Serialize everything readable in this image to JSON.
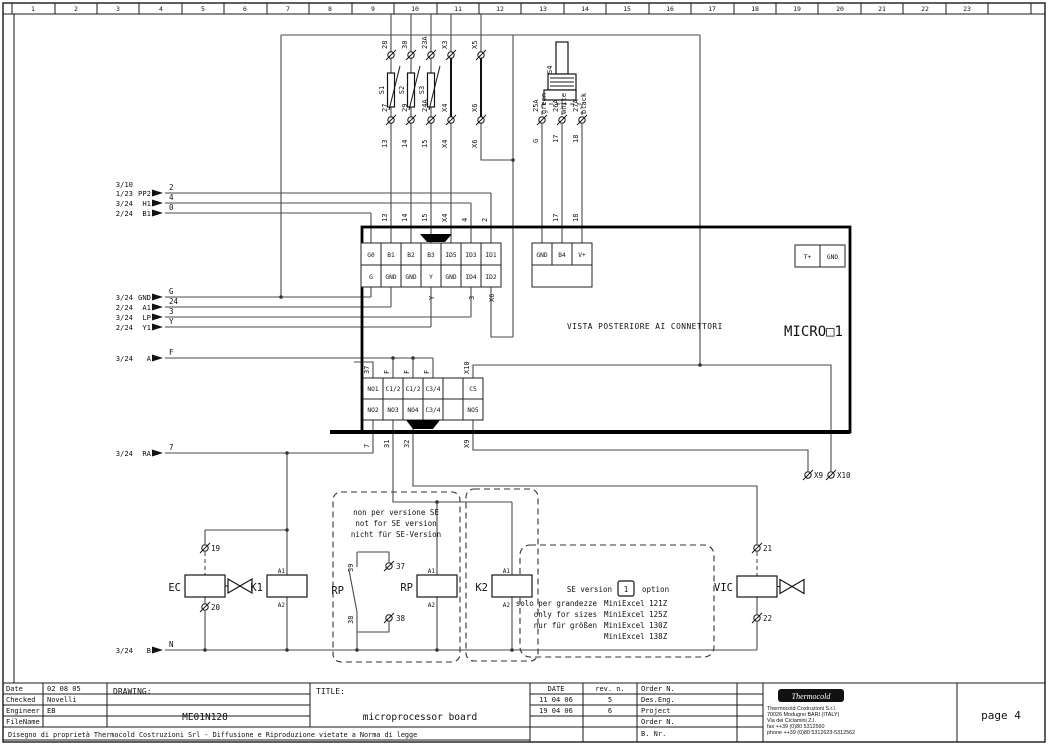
{
  "ruler": {
    "numbers": [
      "1",
      "2",
      "3",
      "4",
      "5",
      "6",
      "7",
      "8",
      "9",
      "10",
      "11",
      "12",
      "13",
      "14",
      "15",
      "16",
      "17",
      "18",
      "19",
      "20",
      "21",
      "22",
      "23"
    ]
  },
  "left_refs": [
    {
      "ref": "3/10",
      "label": "",
      "wire": ""
    },
    {
      "ref": "1/23",
      "label": "PP2",
      "wire": "2"
    },
    {
      "ref": "3/24",
      "label": "H1",
      "wire": "4"
    },
    {
      "ref": "2/24",
      "label": "B1",
      "wire": "0"
    },
    {
      "ref": "3/24",
      "label": "GND",
      "wire": "G"
    },
    {
      "ref": "2/24",
      "label": "A1",
      "wire": "24"
    },
    {
      "ref": "3/24",
      "label": "LP",
      "wire": "3"
    },
    {
      "ref": "2/24",
      "label": "Y1",
      "wire": "Y"
    },
    {
      "ref": "3/24",
      "label": "A",
      "wire": "F"
    },
    {
      "ref": "3/24",
      "label": "RA",
      "wire": "7"
    },
    {
      "ref": "3/24",
      "label": "B",
      "wire": "N"
    }
  ],
  "fuses": {
    "columns": [
      {
        "top": "28",
        "name": "S1",
        "bottom": "27",
        "below": "13"
      },
      {
        "top": "30",
        "name": "S2",
        "bottom": "29",
        "below": "14"
      },
      {
        "top": "23A",
        "name": "S3",
        "bottom": "24A",
        "below": "15"
      },
      {
        "top": "X3",
        "name": "",
        "bottom": "X4",
        "below": "X4"
      },
      {
        "top": "X5",
        "name": "",
        "bottom": "X6",
        "below": "X6"
      }
    ]
  },
  "sensor": {
    "name": "S4",
    "wires": [
      {
        "color": "green",
        "terminal": "25A",
        "wire": "G"
      },
      {
        "color": "white",
        "terminal": "26A",
        "wire": "17"
      },
      {
        "color": "black",
        "terminal": "27A",
        "wire": "18"
      }
    ]
  },
  "micro": {
    "caption": "VISTA POSTERIORE AI CONNETTORI",
    "name": "MICRO□1",
    "connector_a": {
      "top": [
        "G0",
        "B1",
        "B2",
        "B3",
        "ID5",
        "ID3",
        "ID1"
      ],
      "bottom": [
        "G",
        "GND",
        "GND",
        "Y",
        "GND",
        "ID4",
        "ID2"
      ]
    },
    "connector_b": [
      "GND",
      "B4",
      "V+"
    ],
    "connector_c": [
      "T+",
      "GND"
    ],
    "connector_d": {
      "top": [
        "NO1",
        "C1/2",
        "C1/2",
        "C3/4",
        "",
        "C5"
      ],
      "bottom": [
        "NO2",
        "NO3",
        "NO4",
        "C3/4",
        "",
        "NO5"
      ]
    },
    "d_wires_top": [
      "37",
      "F",
      "F",
      "F",
      "X10"
    ],
    "d_wires_bottom": [
      "7",
      "31",
      "32",
      "X9"
    ],
    "under_row": [
      "Y",
      "3",
      "X6"
    ]
  },
  "components": {
    "ec": {
      "name": "EC",
      "t_top": "19",
      "t_bottom": "20"
    },
    "k1": {
      "name": "K1",
      "a1": "A1",
      "a2": "A2"
    },
    "rp_contact": {
      "name": "RP",
      "t_left_top": "39",
      "t_left_bottom": "38",
      "t_top": "37",
      "t_bottom": "38"
    },
    "rp": {
      "name": "RP",
      "a1": "A1",
      "a2": "A2"
    },
    "k2": {
      "name": "K2",
      "a1": "A1",
      "a2": "A2"
    },
    "vic": {
      "name": "VIC",
      "t_top": "21",
      "t_bottom": "22"
    },
    "x9": "X9",
    "x10": "X10"
  },
  "notes": {
    "no_se": [
      "non per versione SE",
      "not for SE version",
      "nicht für SE-Version"
    ],
    "se_prefix": "SE version",
    "se_value": "1",
    "se_suffix": "option",
    "sizes_left": [
      "solo per grandezze",
      "only for sizes",
      "nur für größen",
      ""
    ],
    "sizes_right": [
      "MiniExcel 121Z",
      "MiniExcel 125Z",
      "MiniExcel 130Z",
      "MiniExcel 138Z"
    ]
  },
  "titleblock": {
    "info_rows": [
      {
        "label": "Date",
        "value": "02 08 05"
      },
      {
        "label": "Checked",
        "value": "Novelli"
      },
      {
        "label": "Engineer",
        "value": "EB"
      },
      {
        "label": "FileName",
        "value": ""
      }
    ],
    "drawing_label": "DRAWING:",
    "drawing_value": "ME01N128",
    "title_label": "TITLE:",
    "title_value": "microprocessor board",
    "rev_headers": [
      "DATE",
      "rev. n."
    ],
    "rev_rows": [
      [
        "11 04 06",
        "5"
      ],
      [
        "19 04 06",
        "6"
      ]
    ],
    "order_labels": [
      "Order N.",
      "Des.Eng.",
      "Project",
      "Order N.",
      "B. Nr."
    ],
    "company_logo": "Thermocold",
    "company_lines": [
      "Thermocold Costruzioni S.r.l.",
      "70026 Modugno BARI (ITALY)",
      "Via dei Ciclamini Z.I.",
      "fax ++39 (0)80 5312560",
      "phone ++39 (0)80 5312623-5312562"
    ],
    "page": "page 4",
    "copyright": "Disegno di proprietà Thermocold Costruzioni Srl - Diffusione e Riproduzione vietate a Norma di legge"
  }
}
